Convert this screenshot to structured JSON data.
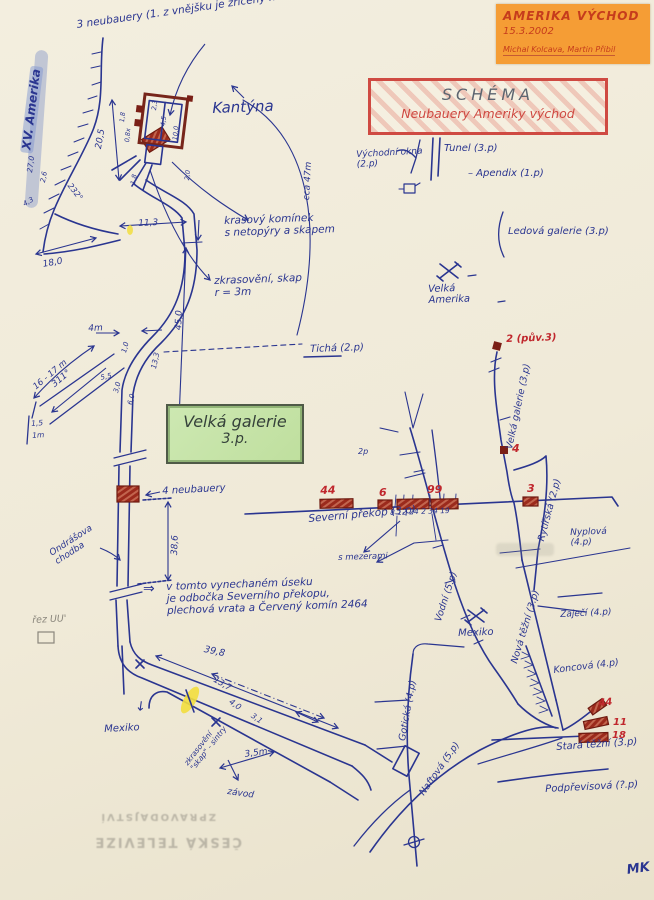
{
  "note": {
    "title": "AMERIKA VÝCHOD",
    "date": "15.3.2002",
    "authors": "Michal Kolcava, Martin Přibil"
  },
  "schema_box": {
    "title": "SCHÉMA",
    "subtitle": "Neubauery Ameriky východ"
  },
  "gallery_box": {
    "line1": "Velká galerie",
    "line2": "3.p."
  },
  "colors": {
    "ink": "#2a3590",
    "red": "#c0272d",
    "darkred": "#7a1f16",
    "gray": "#8a867c",
    "paper": "#f1ecdc",
    "orange": "#f59d35",
    "schema_red": "#cf4a42",
    "green_fill": "#c6e3a8",
    "highlight_yellow": "#f2de3e"
  },
  "labels": [
    {
      "name": "note-3-neubauery",
      "text": "3 neubauery (1. z vnějšku je zřícený na zem)",
      "x": 76,
      "y": 20,
      "rot": -8,
      "size": 10.5,
      "color": "ink"
    },
    {
      "name": "xv-amerika-label",
      "text": "XV. Amerika",
      "x": 20,
      "y": 152,
      "rot": -83,
      "size": 12,
      "color": "ink",
      "cls": "hl"
    },
    {
      "name": "kantyna-label",
      "text": "Kantýna",
      "x": 212,
      "y": 100,
      "rot": -2,
      "size": 15,
      "color": "ink"
    },
    {
      "name": "vychodni-okna-label",
      "text": "Východní okna\n(2.p)",
      "x": 356,
      "y": 150,
      "rot": -3,
      "size": 9,
      "color": "ink"
    },
    {
      "name": "tunel-label",
      "text": "Tunel (3.p)",
      "x": 444,
      "y": 143,
      "rot": 0,
      "size": 10,
      "color": "ink"
    },
    {
      "name": "apendix-label",
      "text": "–  Apendix (1.p)",
      "x": 468,
      "y": 168,
      "rot": 0,
      "size": 10,
      "color": "ink"
    },
    {
      "name": "ledova-galerie-label",
      "text": "Ledová galerie (3.p)",
      "x": 508,
      "y": 226,
      "rot": 0,
      "size": 10,
      "color": "ink"
    },
    {
      "name": "velka-amerika-label",
      "text": "Velká\nAmerika",
      "x": 428,
      "y": 284,
      "rot": -2,
      "size": 10,
      "color": "ink"
    },
    {
      "name": "ticha-label",
      "text": "Tichá (2.p)",
      "x": 310,
      "y": 344,
      "rot": -2,
      "size": 10,
      "color": "ink"
    },
    {
      "name": "marker2-label",
      "text": "2 (pův.3)",
      "x": 506,
      "y": 334,
      "rot": -2,
      "size": 10,
      "color": "red",
      "cls": "b"
    },
    {
      "name": "velka-galerie-line-label",
      "text": "Velká galerie (3.p)",
      "x": 505,
      "y": 448,
      "rot": -78,
      "size": 9.5,
      "color": "ink"
    },
    {
      "name": "marker4-label",
      "text": "4",
      "x": 512,
      "y": 443,
      "rot": 0,
      "size": 11,
      "color": "red",
      "cls": "b"
    },
    {
      "name": "krasovy-kominek-label",
      "text": "krasový komínek\ns netopýry a skapem",
      "x": 224,
      "y": 216,
      "rot": -2,
      "size": 10.5,
      "color": "ink"
    },
    {
      "name": "zkrasoveni-label",
      "text": "zkrasovění, skap\nr = 3m",
      "x": 214,
      "y": 276,
      "rot": -2,
      "size": 10.5,
      "color": "ink"
    },
    {
      "name": "dim-45-0",
      "text": "45,0",
      "x": 174,
      "y": 330,
      "rot": -88,
      "size": 9,
      "color": "ink"
    },
    {
      "name": "dim-18-0",
      "text": "18,0",
      "x": 42,
      "y": 260,
      "rot": -10,
      "size": 9,
      "color": "ink"
    },
    {
      "name": "dim-20-5",
      "text": "20,5",
      "x": 94,
      "y": 148,
      "rot": -80,
      "size": 9,
      "color": "ink"
    },
    {
      "name": "dim-11-3",
      "text": "11,3",
      "x": 138,
      "y": 219,
      "rot": -3,
      "size": 9,
      "color": "ink"
    },
    {
      "name": "dim-cca-47m",
      "text": "cca 47m",
      "x": 302,
      "y": 200,
      "rot": -87,
      "size": 9,
      "color": "ink"
    },
    {
      "name": "dim-4m",
      "text": "4m",
      "x": 88,
      "y": 324,
      "rot": -3,
      "size": 9,
      "color": "ink"
    },
    {
      "name": "dim-16-17m",
      "text": "16 - 17 m",
      "x": 32,
      "y": 385,
      "rot": -40,
      "size": 8.5,
      "color": "ink"
    },
    {
      "name": "dim-311",
      "text": "311°",
      "x": 50,
      "y": 382,
      "rot": -40,
      "size": 9,
      "color": "ink"
    },
    {
      "name": "dim-13-3",
      "text": "13,3",
      "x": 150,
      "y": 368,
      "rot": -78,
      "size": 7.5,
      "color": "ink"
    },
    {
      "name": "dim-1-0",
      "text": "1,0",
      "x": 121,
      "y": 352,
      "rot": -75,
      "size": 7,
      "color": "ink"
    },
    {
      "name": "dim-5-5",
      "text": "5,5",
      "x": 100,
      "y": 375,
      "rot": -12,
      "size": 7,
      "color": "ink"
    },
    {
      "name": "dim-3-0",
      "text": "3,0",
      "x": 113,
      "y": 392,
      "rot": -75,
      "size": 7,
      "color": "ink"
    },
    {
      "name": "dim-6-0",
      "text": "6,0",
      "x": 127,
      "y": 404,
      "rot": -75,
      "size": 7,
      "color": "ink"
    },
    {
      "name": "dim-1-5",
      "text": "1,5",
      "x": 31,
      "y": 420,
      "rot": -4,
      "size": 7.5,
      "color": "ink"
    },
    {
      "name": "dim-1m",
      "text": "1m",
      "x": 32,
      "y": 432,
      "rot": -4,
      "size": 7.5,
      "color": "ink"
    },
    {
      "name": "k-dim-4-5",
      "text": "4,5",
      "x": 160,
      "y": 126,
      "rot": -84,
      "size": 6.5,
      "color": "ink"
    },
    {
      "name": "k-dim-10-0",
      "text": "10,0",
      "x": 172,
      "y": 140,
      "rot": -84,
      "size": 6.5,
      "color": "ink"
    },
    {
      "name": "k-dim-2-3",
      "text": "2,3",
      "x": 151,
      "y": 110,
      "rot": -84,
      "size": 6.5,
      "color": "ink"
    },
    {
      "name": "k-dim-1-8",
      "text": "1,8",
      "x": 119,
      "y": 122,
      "rot": -84,
      "size": 6.5,
      "color": "ink"
    },
    {
      "name": "k-dim-0-8",
      "text": "0,8x",
      "x": 124,
      "y": 142,
      "rot": -84,
      "size": 6.5,
      "color": "ink"
    },
    {
      "name": "k-dim-1-8b",
      "text": "1,8",
      "x": 130,
      "y": 184,
      "rot": -80,
      "size": 6.5,
      "color": "ink"
    },
    {
      "name": "k-dim-2-0",
      "text": "2,0",
      "x": 184,
      "y": 180,
      "rot": -84,
      "size": 6.5,
      "color": "ink"
    },
    {
      "name": "dim-27-0",
      "text": "27,0",
      "x": 26,
      "y": 172,
      "rot": -82,
      "size": 7.5,
      "color": "ink"
    },
    {
      "name": "dim-2-6",
      "text": "2,6",
      "x": 40,
      "y": 182,
      "rot": -80,
      "size": 7,
      "color": "ink"
    },
    {
      "name": "dim-232",
      "text": "232°",
      "x": 72,
      "y": 182,
      "rot": 52,
      "size": 8,
      "color": "ink"
    },
    {
      "name": "dim-4-3",
      "text": "4,3",
      "x": 22,
      "y": 202,
      "rot": -30,
      "size": 7,
      "color": "ink"
    },
    {
      "name": "red-seg-44-label",
      "text": "44",
      "x": 320,
      "y": 485,
      "rot": -2,
      "size": 11,
      "color": "red",
      "cls": "b"
    },
    {
      "name": "red-seg-6-label",
      "text": "6",
      "x": 379,
      "y": 487,
      "rot": 0,
      "size": 11,
      "color": "red",
      "cls": "b"
    },
    {
      "name": "red-seg-99-label",
      "text": "99",
      "x": 427,
      "y": 484,
      "rot": 0,
      "size": 11,
      "color": "red",
      "cls": "b"
    },
    {
      "name": "red-seg-3-label",
      "text": "3",
      "x": 527,
      "y": 483,
      "rot": 0,
      "size": 11,
      "color": "red",
      "cls": "b"
    },
    {
      "name": "seg-counts-label",
      "text": "8 12 24  2  34 19",
      "x": 390,
      "y": 509,
      "rot": -2,
      "size": 7.5,
      "color": "ink"
    },
    {
      "name": "severni-prekop-label",
      "text": "Severní překop (3.p)",
      "x": 308,
      "y": 514,
      "rot": -5,
      "size": 10.5,
      "color": "ink"
    },
    {
      "name": "s-mezerami-label",
      "text": "s mezerami",
      "x": 338,
      "y": 554,
      "rot": -2,
      "size": 8.5,
      "color": "ink"
    },
    {
      "name": "2p-label",
      "text": "2p",
      "x": 358,
      "y": 448,
      "rot": 0,
      "size": 8,
      "color": "ink"
    },
    {
      "name": "4-neubauery-label",
      "text": "4 neubauery",
      "x": 162,
      "y": 486,
      "rot": -3,
      "size": 10,
      "color": "ink"
    },
    {
      "name": "dim-38-6",
      "text": "38,6",
      "x": 170,
      "y": 555,
      "rot": -88,
      "size": 9,
      "color": "ink"
    },
    {
      "name": "ondrasova-chodba-label",
      "text": "Ondrášova\nchodba",
      "x": 48,
      "y": 550,
      "rot": -33,
      "size": 9,
      "color": "ink"
    },
    {
      "name": "rez-uu-label",
      "text": "řez UU'",
      "x": 32,
      "y": 616,
      "rot": -3,
      "size": 9.5,
      "color": "gray"
    },
    {
      "name": "vynechany-usek-note",
      "text": "v tomto vynechaném úseku\nje odbočka Severního překopu,\nplechová vrata a Červený komín 2464",
      "x": 166,
      "y": 582,
      "rot": -2,
      "size": 10.5,
      "color": "ink"
    },
    {
      "name": "double-arrow-glyph",
      "text": "⇒",
      "x": 143,
      "y": 582,
      "rot": 0,
      "size": 14,
      "color": "ink"
    },
    {
      "name": "dim-39-8",
      "text": "39,8",
      "x": 205,
      "y": 645,
      "rot": 12,
      "size": 9.5,
      "color": "ink"
    },
    {
      "name": "dim-13-7",
      "text": "13,7",
      "x": 216,
      "y": 676,
      "rot": 30,
      "size": 8.5,
      "color": "ink"
    },
    {
      "name": "dim-4-0",
      "text": "4,0",
      "x": 232,
      "y": 698,
      "rot": 35,
      "size": 8,
      "color": "ink"
    },
    {
      "name": "dim-3-1",
      "text": "3,1",
      "x": 254,
      "y": 712,
      "rot": 35,
      "size": 7.5,
      "color": "ink"
    },
    {
      "name": "dim-3-5m",
      "text": "3,5m",
      "x": 244,
      "y": 750,
      "rot": -8,
      "size": 9,
      "color": "ink"
    },
    {
      "name": "mexiko-left-label",
      "text": "Mexiko",
      "x": 104,
      "y": 724,
      "rot": -3,
      "size": 10,
      "color": "ink"
    },
    {
      "name": "mexiko-left-arrow",
      "text": "↓",
      "x": 136,
      "y": 700,
      "rot": 8,
      "size": 13,
      "color": "ink"
    },
    {
      "name": "skap-sintry-label",
      "text": "zkrasovění\n\"skap\" - sintry",
      "x": 183,
      "y": 762,
      "rot": -52,
      "size": 7.5,
      "color": "ink"
    },
    {
      "name": "zavod-label",
      "text": "závod",
      "x": 228,
      "y": 787,
      "rot": 8,
      "size": 9,
      "color": "ink"
    },
    {
      "name": "rytirska-label",
      "text": "Rytířská (2.p)",
      "x": 537,
      "y": 540,
      "rot": -75,
      "size": 9.5,
      "color": "ink"
    },
    {
      "name": "nyplova-label",
      "text": "Nyplová\n(4.p)",
      "x": 570,
      "y": 528,
      "rot": -2,
      "size": 9,
      "color": "ink"
    },
    {
      "name": "zajeci-label",
      "text": "Zaječí (4.p)",
      "x": 560,
      "y": 610,
      "rot": -3,
      "size": 9,
      "color": "ink"
    },
    {
      "name": "nova-tezni-label",
      "text": "Nová těžní (3.p)",
      "x": 510,
      "y": 662,
      "rot": -73,
      "size": 9.5,
      "color": "ink"
    },
    {
      "name": "koncova-label",
      "text": "Koncová (4.p)",
      "x": 553,
      "y": 666,
      "rot": -7,
      "size": 9.5,
      "color": "ink"
    },
    {
      "name": "vodni-label",
      "text": "Vodní (5.p)",
      "x": 434,
      "y": 620,
      "rot": -72,
      "size": 9.5,
      "color": "ink"
    },
    {
      "name": "mexiko-right-label",
      "text": "Mexiko",
      "x": 458,
      "y": 628,
      "rot": -2,
      "size": 10,
      "color": "ink"
    },
    {
      "name": "goticka-label",
      "text": "Gotická (4.p)",
      "x": 398,
      "y": 740,
      "rot": -80,
      "size": 9.5,
      "color": "ink"
    },
    {
      "name": "naftova-label",
      "text": "Naftová (5.p)",
      "x": 418,
      "y": 792,
      "rot": -55,
      "size": 9.5,
      "color": "ink"
    },
    {
      "name": "stara-tezni-label",
      "text": "Stará těžní (3.p)",
      "x": 556,
      "y": 742,
      "rot": -4,
      "size": 10,
      "color": "ink"
    },
    {
      "name": "red-44b-label",
      "text": "44",
      "x": 598,
      "y": 698,
      "rot": -5,
      "size": 10,
      "color": "red",
      "cls": "b"
    },
    {
      "name": "red-11-label",
      "text": "11",
      "x": 613,
      "y": 717,
      "rot": 0,
      "size": 10,
      "color": "red",
      "cls": "b"
    },
    {
      "name": "red-18-label",
      "text": "18",
      "x": 612,
      "y": 730,
      "rot": 0,
      "size": 10,
      "color": "red",
      "cls": "b"
    },
    {
      "name": "podprevisova-label",
      "text": "Podpřevisová (?.p)",
      "x": 545,
      "y": 784,
      "rot": -3,
      "size": 10,
      "color": "ink"
    },
    {
      "name": "signature",
      "text": "MK",
      "x": 626,
      "y": 864,
      "rot": -8,
      "size": 13,
      "color": "ink",
      "cls": "b"
    },
    {
      "name": "watermark-line1",
      "text": "ZPRAVODAJSTVÍ",
      "x": 216,
      "y": 822,
      "rot": 180,
      "size": 10,
      "color": "gray",
      "cls": "wm"
    },
    {
      "name": "watermark-line2",
      "text": "ČESKÁ TELEVIZE",
      "x": 242,
      "y": 848,
      "rot": 180,
      "size": 13,
      "color": "gray",
      "cls": "wm"
    }
  ]
}
